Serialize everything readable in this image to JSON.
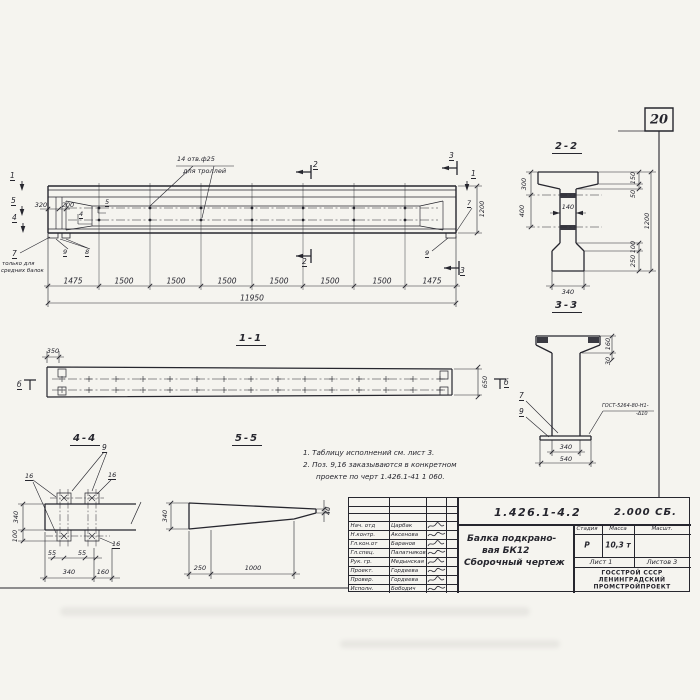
{
  "page": {
    "number": "20"
  },
  "main_view": {
    "holes_note": [
      "14 отв.ф25",
      "для троллей"
    ],
    "view_marks": {
      "v1": "1",
      "v5": "5",
      "v4": "4",
      "v1r": "1"
    },
    "section_marks": {
      "s2": "2",
      "s3": "3"
    },
    "pos_labels": {
      "p7_left": "7",
      "p8": "8",
      "p9_left": "9",
      "p9_right": "9",
      "p7_right": "7",
      "p5": "5",
      "p4": "4"
    },
    "left_note": [
      "только для",
      "средних балок"
    ],
    "dims": {
      "d320": "320",
      "d200": "200",
      "d1200": "1200",
      "total": "11950",
      "segments": [
        "1475",
        "1500",
        "1500",
        "1500",
        "1500",
        "1500",
        "1500",
        "1475"
      ]
    }
  },
  "section_1_1": {
    "title": "1-1",
    "dims": {
      "d350": "350",
      "d650": "650"
    },
    "marks": {
      "b_left": "б",
      "b_right": "б"
    }
  },
  "section_2_2": {
    "title": "2-2",
    "dims": {
      "d300": "300",
      "d400": "400",
      "d140": "140",
      "d150": "150",
      "d50": "50",
      "d1200": "1200",
      "d100": "100",
      "d250": "250",
      "d340": "340"
    }
  },
  "section_3_3": {
    "title": "3-3",
    "pos": {
      "p7": "7",
      "p9": "9"
    },
    "weld_note": [
      "ГОСТ-5264-80-Н1-",
      "-Δ10"
    ],
    "dims": {
      "d160": "160",
      "d30": "30",
      "d340": "340",
      "d540": "540"
    }
  },
  "section_4_4": {
    "title": "4-4",
    "pos": {
      "p9": "9",
      "p16a": "16",
      "p16b": "16",
      "p16c": "16"
    },
    "dims": {
      "d340v": "340",
      "d100": "100",
      "d55a": "55",
      "d55b": "55",
      "d340": "340",
      "d160": "160"
    }
  },
  "section_5_5": {
    "title": "5-5",
    "dims": {
      "d340": "340",
      "d40": "40",
      "d250": "250",
      "d1000": "1000"
    }
  },
  "notes": {
    "line1": "1. Таблицу исполнений см. лист 3.",
    "line2": "2. Поз. 9,16 заказываются в конкретном",
    "line3": "проекте по черт 1.426.1-41 1 060."
  },
  "title_block": {
    "doc_number": "1.426.1-4.2",
    "doc_code": "2.000 СБ.",
    "title_lines": [
      "Балка подкрано-",
      "вая БК12",
      "Сборочный чертеж"
    ],
    "columns": {
      "stage": "Стадия",
      "mass": "Масса",
      "scale": "Масшт."
    },
    "values": {
      "stage": "Р",
      "mass": "10,3 т"
    },
    "sheet": "Лист 1",
    "sheets": "Листов 3",
    "org": [
      "ГОССТРОЙ СССР",
      "ЛЕНИНГРАДСКИЙ",
      "ПРОМСТРОЙПРОЕКТ"
    ],
    "signers": [
      {
        "role": "Нач. отд",
        "name": "Царбак"
      },
      {
        "role": "Н.контр.",
        "name": "Аксенова"
      },
      {
        "role": "Гл.кон.от",
        "name": "Баранов"
      },
      {
        "role": "Гл.спец.",
        "name": "Палатников"
      },
      {
        "role": "Рук. гр.",
        "name": "Медынская"
      },
      {
        "role": "Проект.",
        "name": "Гордеева"
      },
      {
        "role": "Провер.",
        "name": "Гордеева"
      },
      {
        "role": "Исполн.",
        "name": "Бободич"
      }
    ]
  }
}
